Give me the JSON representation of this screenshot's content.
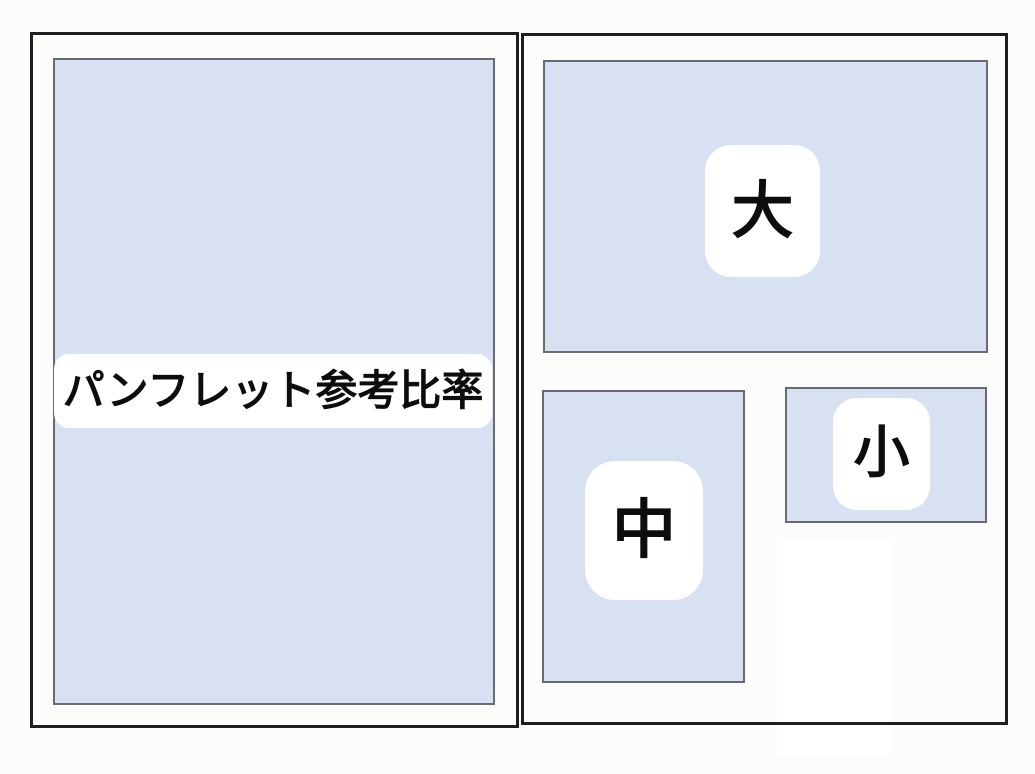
{
  "diagram": {
    "title_badge": "パンフレット参考比率",
    "sizes": {
      "large": "大",
      "medium": "中",
      "small": "小"
    }
  },
  "colors": {
    "page_background": "#fcfcfb",
    "frame_border": "#1e1e21",
    "sheet_fill": "#d8e1f2",
    "sheet_border": "#6a6a74",
    "badge_background": "#ffffff",
    "badge_text": "#0d0d0d"
  }
}
